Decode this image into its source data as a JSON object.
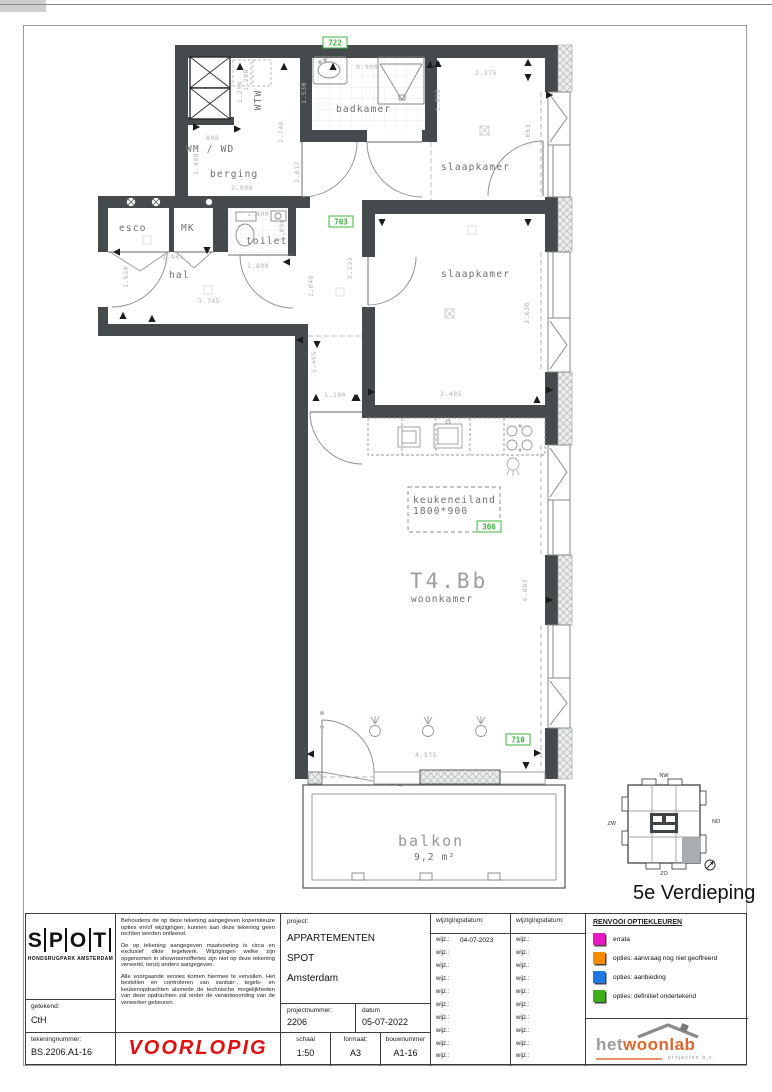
{
  "plan": {
    "unit_title": "T4.Bb",
    "labels": {
      "wtw": "WTW",
      "wm_wd": "WM / WD",
      "berging": "berging",
      "badkamer": "badkamer",
      "slaapkamer1": "slaapkamer",
      "slaapkamer2": "slaapkamer",
      "esco": "esco",
      "mk": "MK",
      "toilet": "toilet",
      "hal": "hal",
      "keukeneiland": "keukeneiland",
      "keuken_size": "1800*900",
      "woonkamer": "woonkamer",
      "balkon": "balkon",
      "balkon_area": "9,2  m²"
    },
    "options": [
      "722",
      "703",
      "306",
      "710"
    ],
    "dims": [
      "1.200",
      "1.250",
      "2.748",
      "808",
      "1.498",
      "2.908",
      "0.900",
      "1.530",
      "1.830",
      "2.375",
      "3.063",
      "1.945",
      "1.930",
      "3.745",
      "1.490",
      "1.090",
      "1.890",
      "1.040",
      "5.133",
      "3.630",
      "3.485",
      "1.100",
      "1.465",
      "6.893",
      "4.575",
      "2.017"
    ],
    "option_color": "#3db53d"
  },
  "keyplan": {
    "floor": "5e Verdieping",
    "compass": {
      "nw": "NW",
      "zw": "ZW",
      "no": "NO",
      "zo": "ZO"
    }
  },
  "titleblock": {
    "logo": {
      "letters": [
        "S",
        "P",
        "O",
        "T"
      ],
      "subtitle": "HONDSRUGPARK AMSTERDAM"
    },
    "getekend_label": "getekend:",
    "getekend_value": "CtH",
    "tekeningnummer_label": "tekeningnummer:",
    "tekeningnummer_value": "BS.2206.A1-16",
    "disclaimer": [
      "Behoudens de op deze tekening aangegeven koperskeuze opties en/of wijzigingen, kunnen aan deze tekening geen rechten worden ontleend.",
      "De op tekening aangegeven maatvoering is circa en exclusief dikte tegelwerk. Wijzigingen welke zijn opgenomen in showroomoffertes zijn niet op deze tekening verwerkt, tenzij anders aangegeven.",
      "Alle voorgaande versies komen hiermee te vervallen. Het bestellen en controleren van sanitair-, tegels- en keukenopdrachten alsmede de technische mogelijkheden van deze opdrachten zal onder de verantwoording van de verwerker gebeuren."
    ],
    "voorlopig": "VOORLOPIG",
    "project_label": "project:",
    "project_lines": [
      "APPARTEMENTEN",
      "SPOT",
      "Amsterdam"
    ],
    "projectnummer_label": "projectnummer:",
    "projectnummer_value": "2206",
    "datum_label": "datum",
    "datum_value": "05-07-2022",
    "schaal_label": "schaal",
    "schaal_value": "1:50",
    "formaat_label": "formaat:",
    "formaat_value": "A3",
    "bouwnummer_label": "bouwnummer",
    "bouwnummer_value": "A1-16",
    "wijzigingen": {
      "header": "wijzigingsdatum:",
      "row_label": "wijz.:",
      "col1_values": [
        "04-07-2023",
        "",
        "",
        "",
        "",
        "",
        "",
        "",
        "",
        ""
      ],
      "col2_values": [
        "",
        "",
        "",
        "",
        "",
        "",
        "",
        "",
        "",
        ""
      ]
    },
    "renvooi": {
      "title": "RENVOOI OPTIEKLEUREN",
      "items": [
        {
          "color": "#e818c1",
          "label": "errata"
        },
        {
          "color": "#f78b00",
          "label": "opties: aanvraag nog niet geoffreerd"
        },
        {
          "color": "#1d78e0",
          "label": "opties: aanbieding"
        },
        {
          "color": "#3fae1f",
          "label": "opties: definitief ondertekend"
        }
      ]
    },
    "woonlab": {
      "part1": "het",
      "part2": "woonlab",
      "subtitle": "projecten b.v."
    }
  }
}
